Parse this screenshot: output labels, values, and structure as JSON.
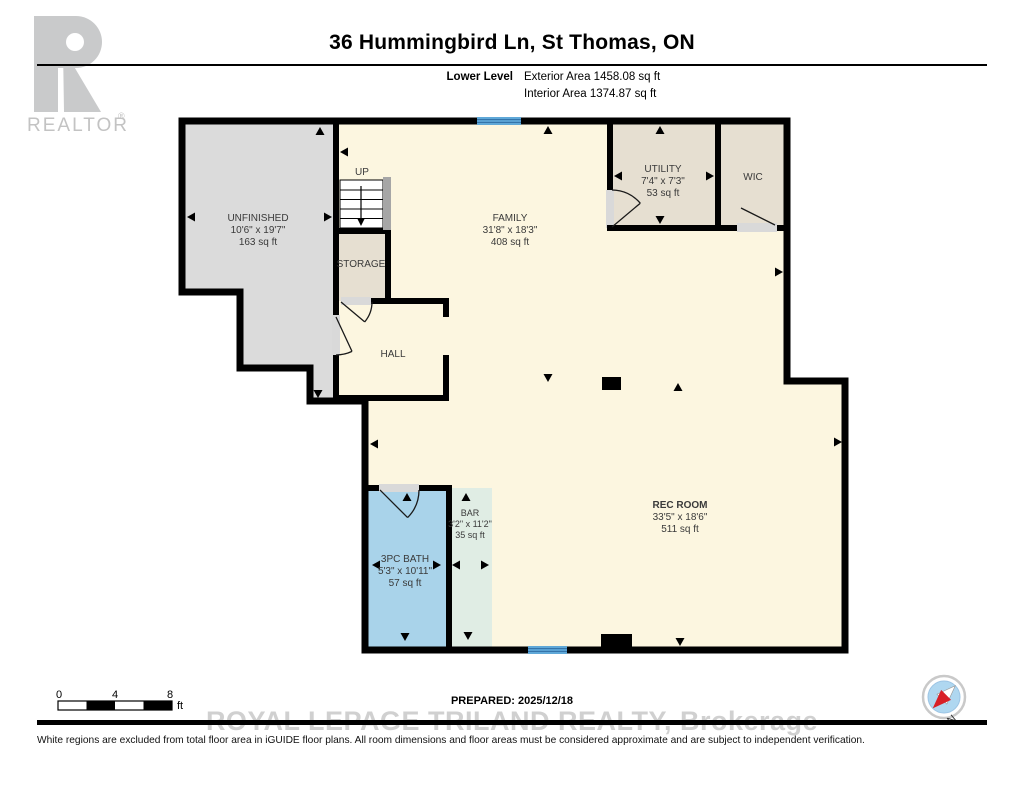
{
  "header": {
    "title": "36 Hummingbird Ln, St Thomas, ON",
    "level_label": "Lower Level",
    "exterior_area": "Exterior Area 1458.08 sq ft",
    "interior_area": "Interior Area 1374.87 sq ft",
    "logo_text": "REALTOR",
    "logo_reg": "®"
  },
  "rooms": {
    "unfinished": {
      "name": "UNFINISHED",
      "dims": "10'6\" x 19'7\"",
      "area": "163 sq ft"
    },
    "family": {
      "name": "FAMILY",
      "dims": "31'8\" x 18'3\"",
      "area": "408 sq ft"
    },
    "utility": {
      "name": "UTILITY",
      "dims": "7'4\" x 7'3\"",
      "area": "53 sq ft"
    },
    "wic": {
      "name": "WIC"
    },
    "storage": {
      "name": "STORAGE"
    },
    "hall": {
      "name": "HALL"
    },
    "stairs": {
      "label": "UP"
    },
    "bath": {
      "name": "3PC BATH",
      "dims": "5'3\" x 10'11\"",
      "area": "57 sq ft"
    },
    "bar": {
      "name": "BAR",
      "dims": "3'2\" x 11'2\"",
      "area": "35 sq ft"
    },
    "rec_room": {
      "name": "REC ROOM",
      "dims": "33'5\" x 18'6\"",
      "area": "511 sq ft"
    }
  },
  "footer": {
    "scale_ticks": [
      "0",
      "4",
      "8"
    ],
    "scale_unit": "ft",
    "prepared": "PREPARED: 2025/12/18",
    "watermark": "ROYAL LEPAGE TRILAND REALTY, Brokerage",
    "disclaimer": "White regions are excluded from total floor area in iGUIDE floor plans. All room dimensions and floor areas must be considered approximate and are subject to independent verification.",
    "compass_north": "N"
  },
  "colors": {
    "floor": "#FCF6E0",
    "unfinished": "#DBDBDB",
    "closet": "#E6DFD1",
    "bath": "#A9D3EA",
    "bar": "#E0EDE4",
    "window": "#5FA8D8",
    "window_line": "#2E6DA4",
    "wall": "#000000",
    "stair_rail": "#A6A6A6",
    "compass_fill": "#AFD7F0",
    "compass_needle": "#D81F26"
  }
}
